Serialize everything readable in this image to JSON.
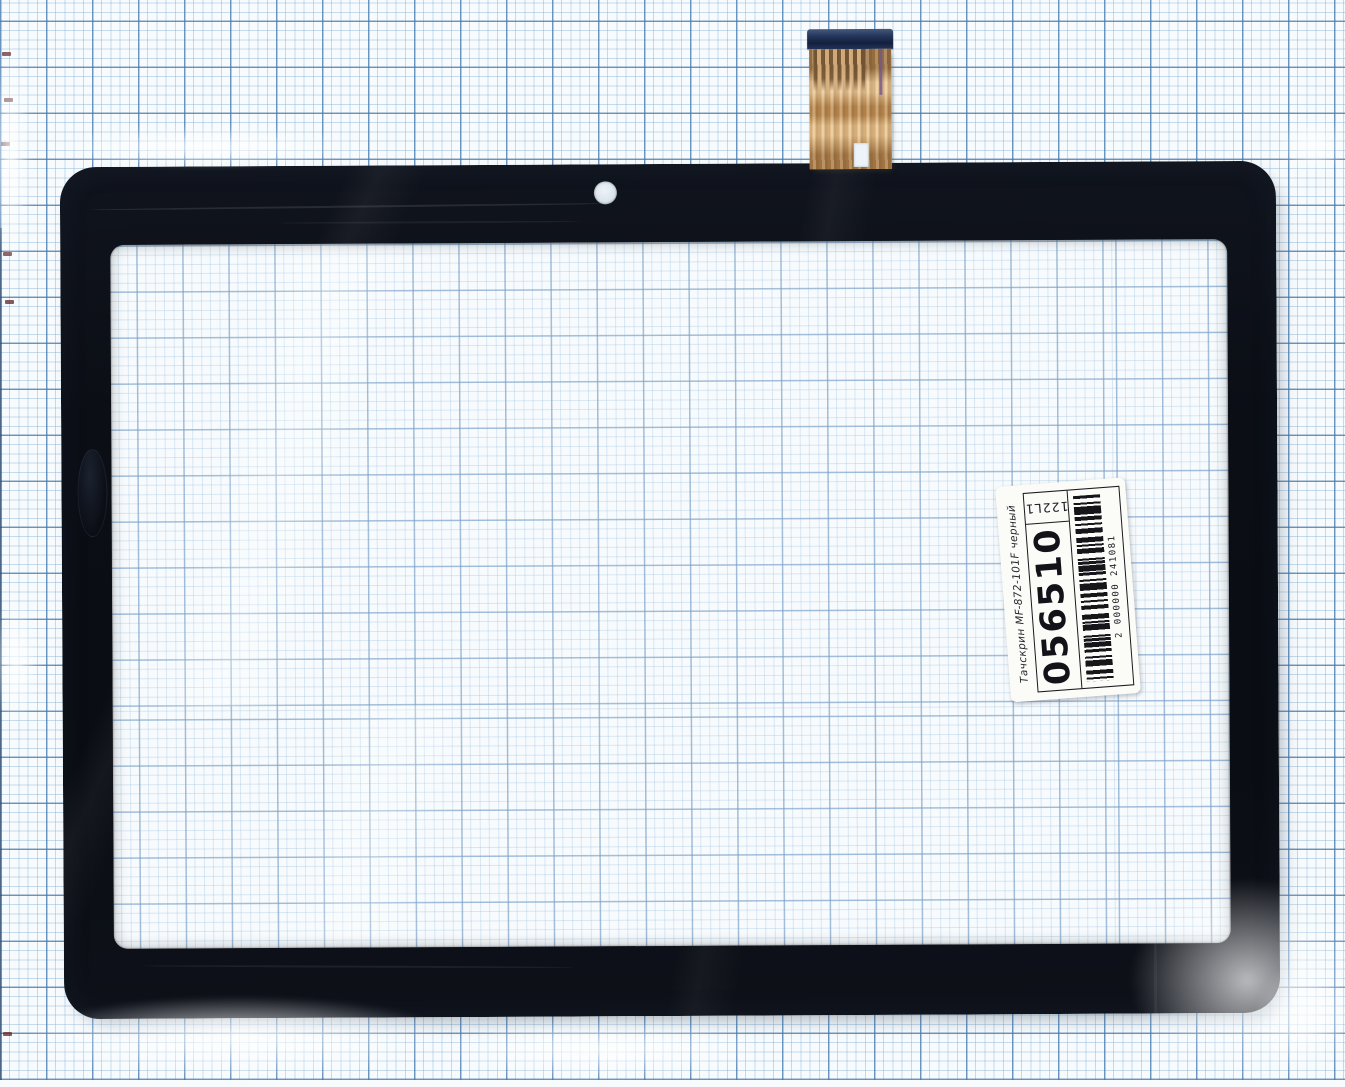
{
  "label": {
    "product_text": "Тачскрин MF-872-101F черный",
    "stock_number": "056510",
    "cell_code": "122L1",
    "barcode_digits": "2 000000 241081"
  },
  "colors": {
    "frame_black": "#0b0e15",
    "cable_gold": "#c89a62",
    "cable_stiffener_navy": "#24365c",
    "paper_background": "#f7fbfd",
    "grid_minor_blue": "#86b0d4",
    "grid_major_blue": "#4276ac",
    "label_background": "#fbfbf8"
  }
}
